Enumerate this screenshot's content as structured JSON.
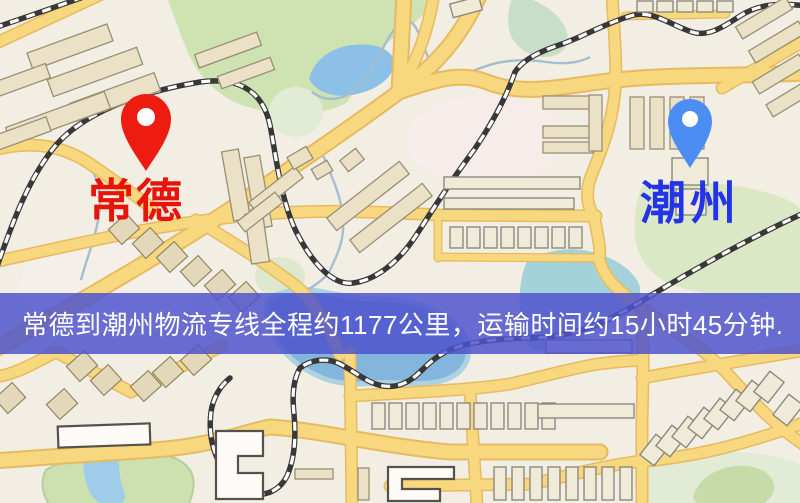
{
  "map": {
    "origin": {
      "name": "常德",
      "pin_color": "#ee1c10",
      "label_color": "#e8140a"
    },
    "destination": {
      "name": "潮州",
      "pin_color": "#4c8df3",
      "label_color": "#2433e8"
    },
    "banner": {
      "text": "常德到潮州物流专线全程约1177公里，运输时间约15小时45分钟.",
      "distance_km": "1177",
      "duration_text": "15小时45分钟",
      "background_color": "#4d52cd",
      "text_color": "#ffffff"
    },
    "colors": {
      "land": "#f2eee4",
      "road_fill": "#f8d87e",
      "road_casing": "#e6ba60",
      "park_green": "#cfe2b2",
      "water_blue": "#84b5dc",
      "railway_dark": "#383838"
    }
  }
}
